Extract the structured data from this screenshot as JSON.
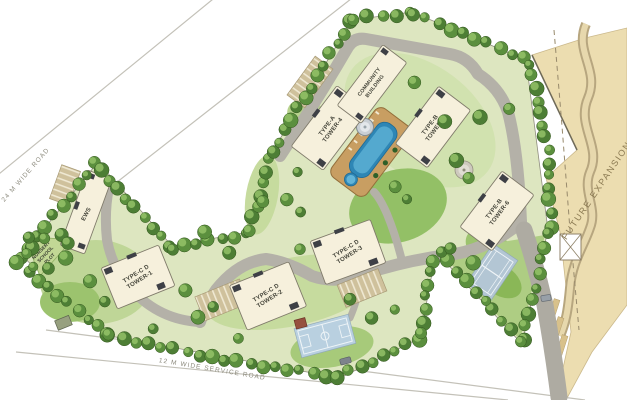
{
  "title": "Residential Township Master Site Plan",
  "roads": {
    "wide_road_label": "24 M WIDE ROAD",
    "service_road_label": "12 M  WIDE SERVICE ROAD"
  },
  "areas": {
    "future_expansion": "FUTURE EXPANSION",
    "nursery_line1": "NURSERY",
    "nursery_line2": "SCHOOL",
    "nursery_line3": "PLOT"
  },
  "buildings": {
    "ews": {
      "line1": "EWS",
      "line2": ""
    },
    "tower1": {
      "line1": "TYPE-C D",
      "line2": "TOWER-1"
    },
    "tower2": {
      "line1": "TYPE-C D",
      "line2": "TOWER-2"
    },
    "tower3": {
      "line1": "TYPE-C D",
      "line2": "TOWER-3"
    },
    "tower4": {
      "line1": "TYPE-A",
      "line2": "TOWER-4"
    },
    "tower5": {
      "line1": "TYPE-B",
      "line2": "TOWER-5"
    },
    "tower6": {
      "line1": "TYPE-B",
      "line2": "TOWER-6"
    },
    "community": {
      "line1": "COMMUNITY",
      "line2": "BUILDING"
    }
  },
  "palette": {
    "site_green_base": "#dde6c0",
    "lawn_green": "#93c066",
    "tree_green": "#4d7e35",
    "road_gray": "#b4b1a8",
    "building_cream": "#f6f0dc",
    "pool_blue": "#2e86b5",
    "court_blue": "#b9d0e0",
    "future_beige": "#ecddb0"
  }
}
